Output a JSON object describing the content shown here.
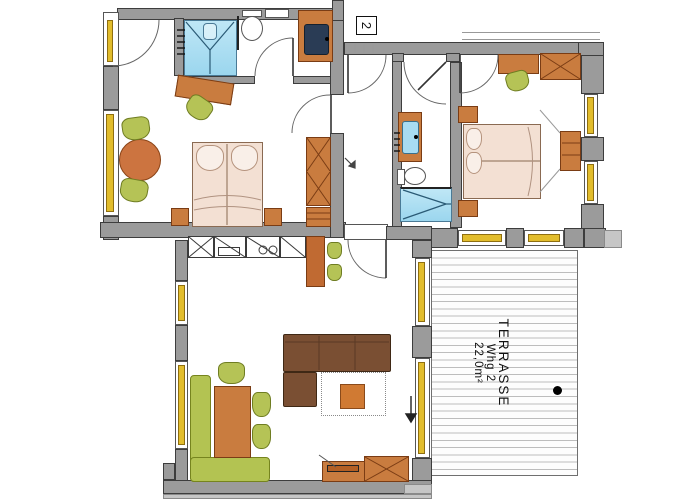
{
  "labels": {
    "apartment_number": "2",
    "terrace_name": "TERRASSE",
    "terrace_unit": "Whg 2",
    "terrace_area": "22,0m²"
  },
  "colors": {
    "wall": "#9b9b9b",
    "window_yellow": "#e2bd2d",
    "furniture_orange": "#c97c3f",
    "seating_green": "#b5c356",
    "water_cyan": "#a8dcf2",
    "sofa_brown": "#7a4f33",
    "bed_peach": "#f3e0d3",
    "dining_bench_green": "#b3c352",
    "deck_line": "#bdbdbd"
  },
  "rooms": [
    {
      "name": "bedroom-left",
      "furniture": [
        "double-bed",
        "nightstands",
        "round-table",
        "chairs",
        "desk",
        "wardrobe",
        "dresser"
      ]
    },
    {
      "name": "bathroom-top",
      "furniture": [
        "shower",
        "toilet",
        "washbasin"
      ]
    },
    {
      "name": "hallway",
      "furniture": []
    },
    {
      "name": "bathroom-middle",
      "furniture": [
        "washbasin",
        "toilet",
        "shower"
      ]
    },
    {
      "name": "bedroom-right",
      "furniture": [
        "double-bed",
        "nightstands",
        "desk",
        "wardrobe",
        "tv-dresser"
      ]
    },
    {
      "name": "living-room",
      "furniture": [
        "kitchenette",
        "bar-counter",
        "bar-stools",
        "corner-sofa",
        "rug",
        "coffee-table",
        "dining-table",
        "corner-bench",
        "chairs",
        "tv-lowboard",
        "cabinet"
      ]
    },
    {
      "name": "terrace",
      "furniture": [
        "decking"
      ]
    }
  ]
}
